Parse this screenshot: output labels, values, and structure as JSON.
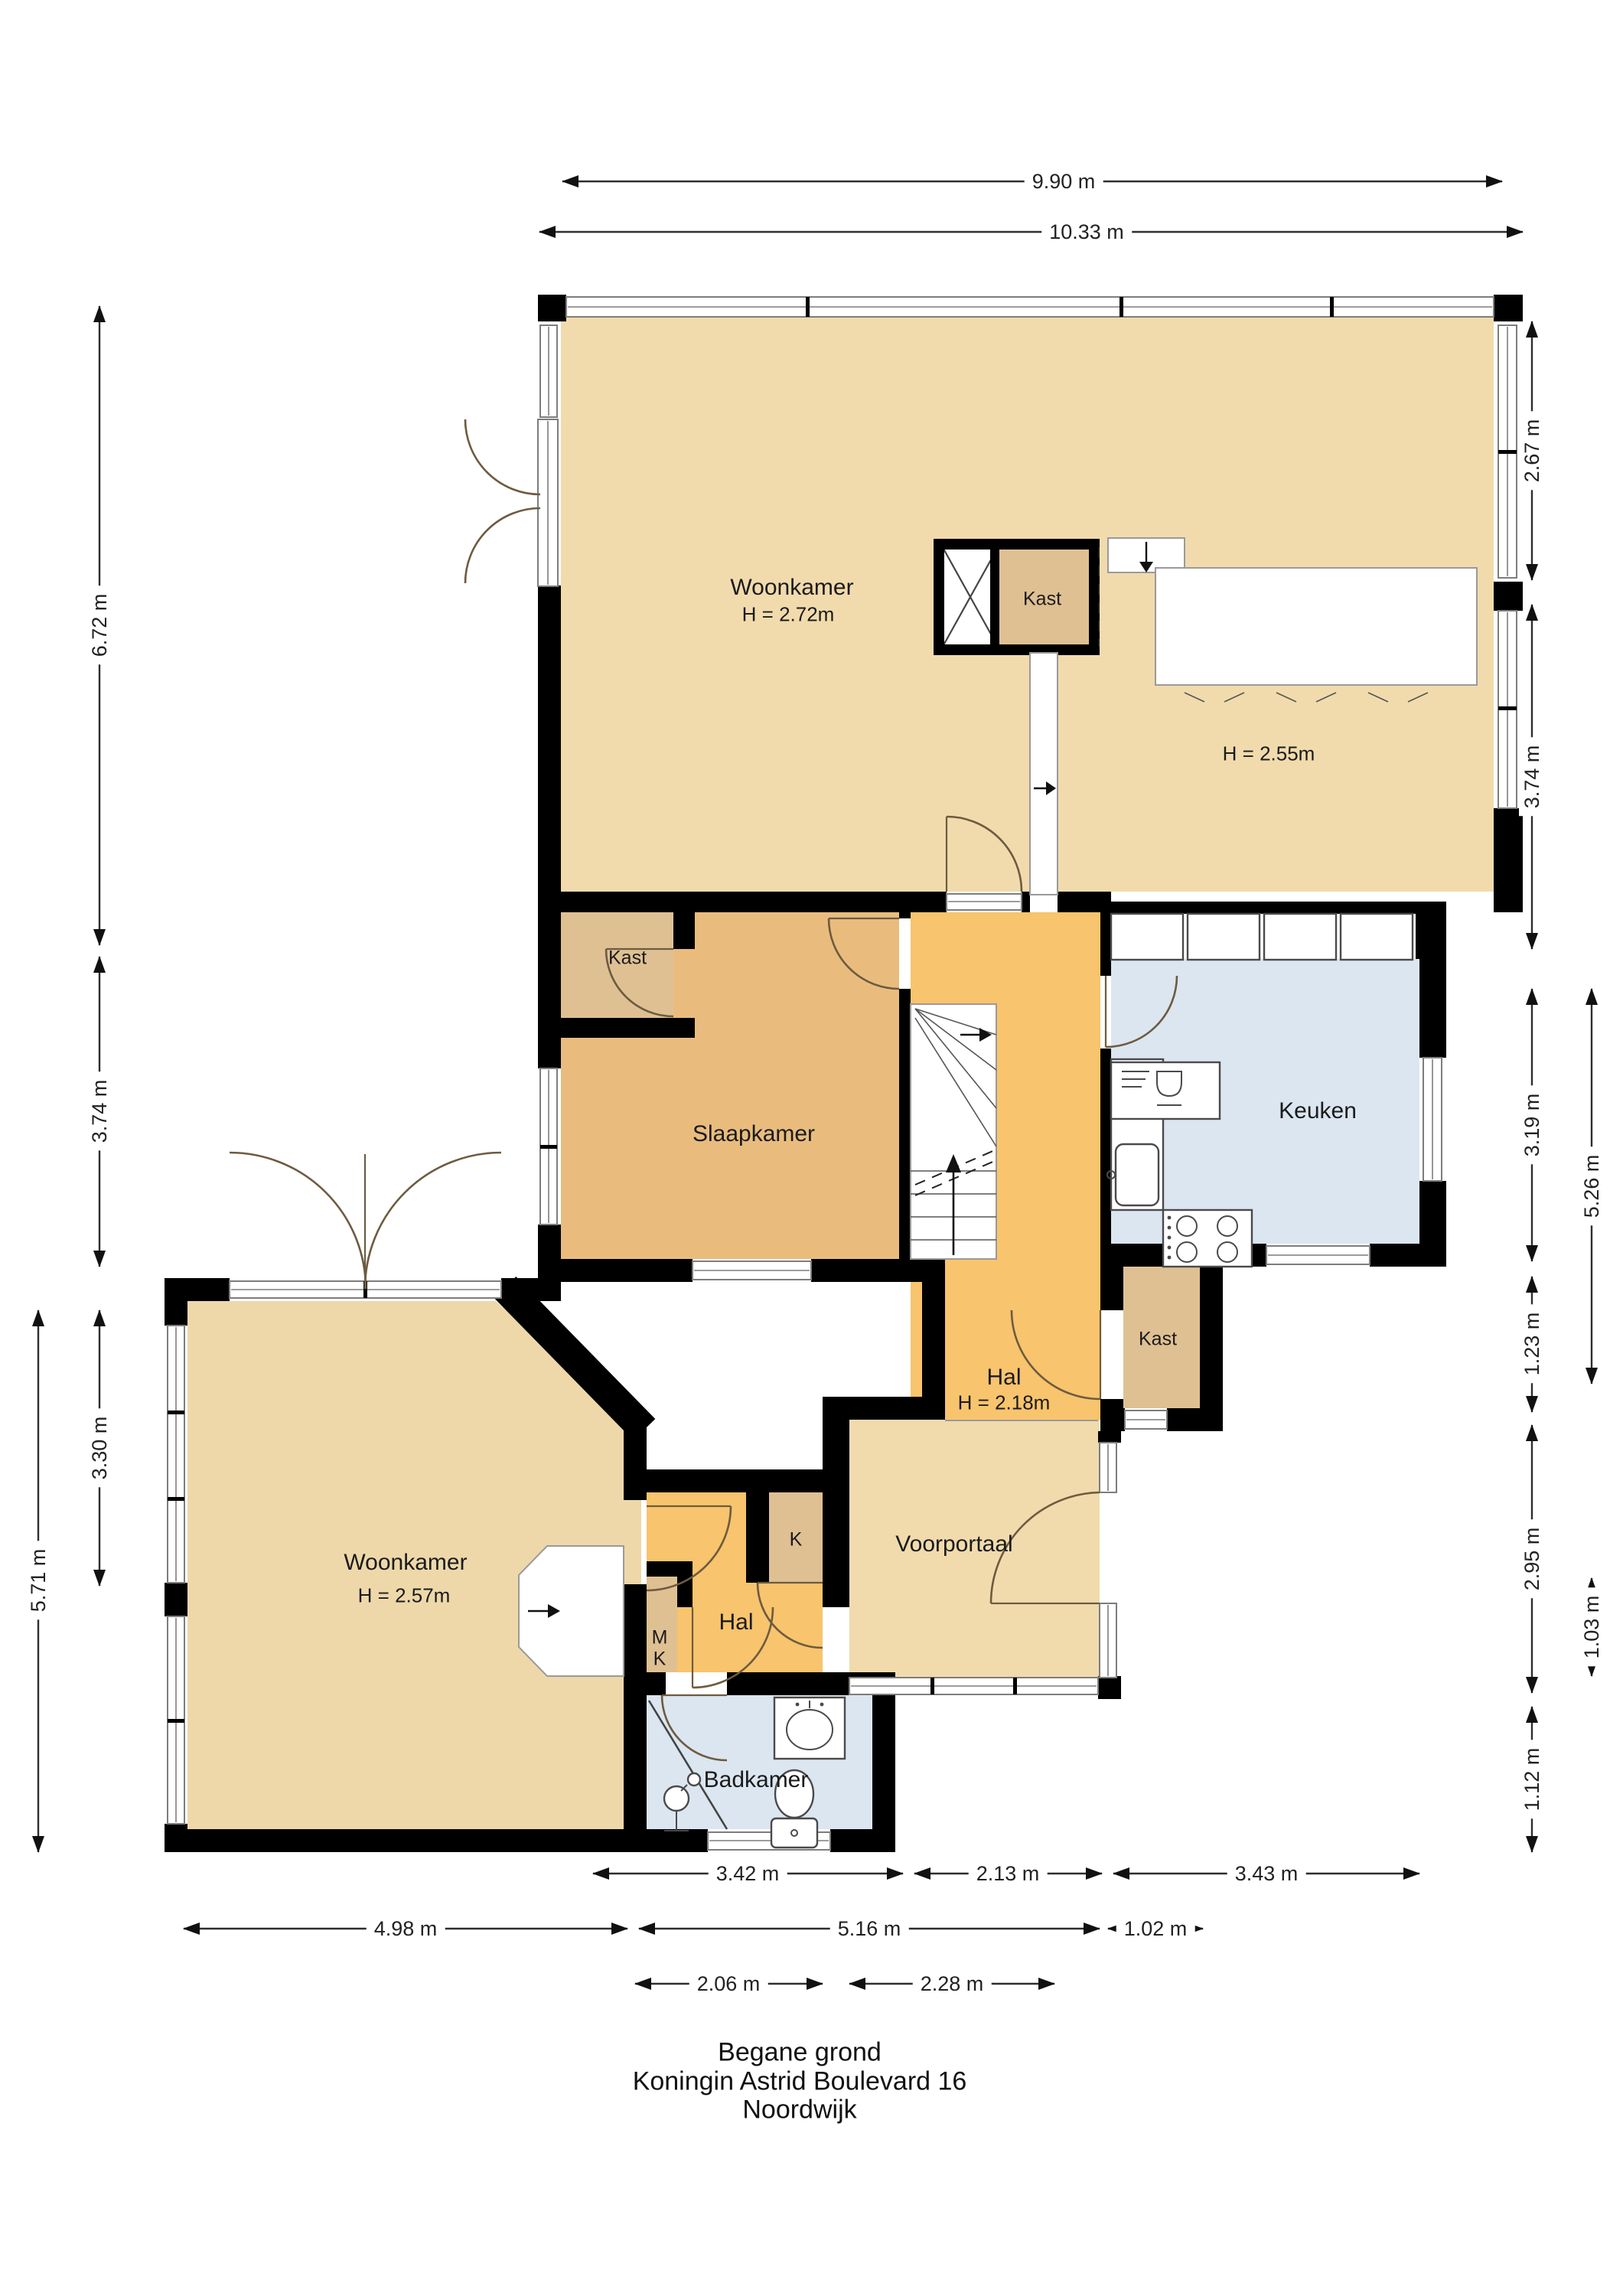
{
  "title": {
    "line1": "Begane grond",
    "line2": "Koningin Astrid Boulevard 16",
    "line3": "Noordwijk"
  },
  "rooms": {
    "woonkamer_top": {
      "name": "Woonkamer",
      "height": "H = 2.72m"
    },
    "open_area": {
      "height": "H = 2.55m"
    },
    "kast_top": {
      "name": "Kast"
    },
    "slaapkamer": {
      "name": "Slaapkamer"
    },
    "kast_slaapkamer": {
      "name": "Kast"
    },
    "keuken": {
      "name": "Keuken"
    },
    "kast_keuken": {
      "name": "Kast"
    },
    "hal": {
      "name": "Hal",
      "height": "H = 2.18m"
    },
    "voorportaal": {
      "name": "Voorportaal"
    },
    "k_closet": {
      "name": "K"
    },
    "mk_closet": {
      "line1": "M",
      "line2": "K"
    },
    "hal_klein": {
      "name": "Hal"
    },
    "badkamer": {
      "name": "Badkamer"
    },
    "woonkamer_bottom": {
      "name": "Woonkamer",
      "height": "H = 2.57m"
    }
  },
  "dimensions": {
    "top_inner": "9.90 m",
    "top_outer": "10.33 m",
    "left_1": "6.72 m",
    "left_2": "3.74 m",
    "left_3": "3.30 m",
    "left_outer": "5.71 m",
    "right_1": "2.67 m",
    "right_2": "3.74 m",
    "right_3": "3.19 m",
    "right_4": "1.23 m",
    "right_5": "2.95 m",
    "right_6": "1.12 m",
    "right_outer_1": "5.26 m",
    "right_outer_2": "1.03 m",
    "bottom_1": "3.42 m",
    "bottom_2": "2.13 m",
    "bottom_3": "3.43 m",
    "bottom_4": "4.98 m",
    "bottom_5": "5.16 m",
    "bottom_6": "1.02 m",
    "bottom_7": "2.06 m",
    "bottom_8": "2.28 m"
  },
  "colors": {
    "floor_light": "#f1dbad",
    "floor_ochre": "#e9bc7e",
    "floor_closet": "#dfc093",
    "floor_hall": "#f8c46d",
    "floor_wet": "#dbe6f0",
    "floor_bottom_room": "#eed8aa",
    "wall": "#000000"
  }
}
